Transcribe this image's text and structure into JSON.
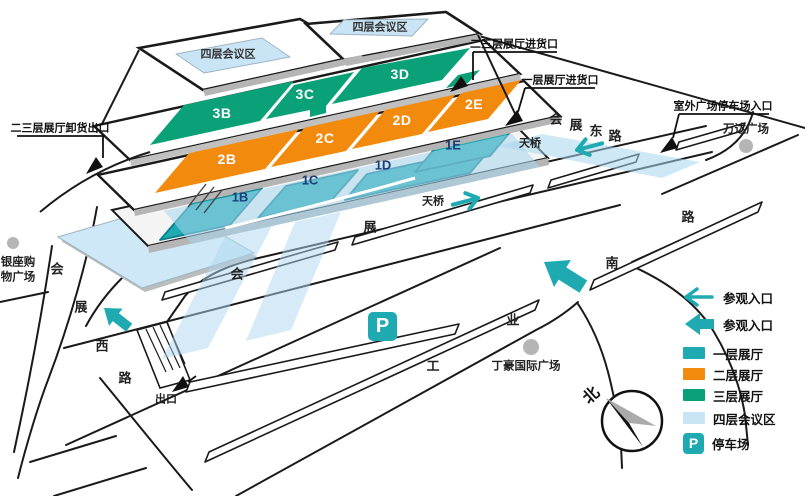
{
  "colors": {
    "teal": "#1FAAB2",
    "orange": "#F28B0D",
    "green": "#0AA178",
    "lightblue": "#C9E4F5",
    "navy": "#1A3E7C",
    "line": "#1a1a1a",
    "gray": "#B5B5B5"
  },
  "conference": {
    "left": "四层会议区",
    "right": "四层会议区"
  },
  "halls": {
    "f3": [
      "3B",
      "3C",
      "3D"
    ],
    "f2": [
      "2B",
      "2C",
      "2D",
      "2E"
    ],
    "f1": [
      "1B",
      "1C",
      "1D",
      "1E"
    ]
  },
  "callouts": {
    "load23": "二三层展厅进货口",
    "load1": "一层展厅进货口",
    "outdoor_parking": "室外广场停车场入口",
    "unload23": "二三层展厅卸货出口"
  },
  "places": {
    "wanda": "万达广场",
    "dinghao": "丁豪国际广场",
    "yinzuo_line1": "银座购",
    "yinzuo_line2": "物广场"
  },
  "roads": {
    "east": [
      "会",
      "展",
      "东",
      "路"
    ],
    "west": [
      "会",
      "展",
      "西",
      "路"
    ],
    "south": [
      "工",
      "业",
      "南",
      "路"
    ],
    "front": [
      "会",
      "展"
    ]
  },
  "bridges": {
    "b1": "天桥",
    "b2": "天桥"
  },
  "misc": {
    "exit": "出口",
    "parking_p": "P",
    "compass_north": "北"
  },
  "legend": {
    "items": [
      {
        "icon": "thin-arrow",
        "label": "参观入口"
      },
      {
        "icon": "thick-arrow",
        "label": "参观入口"
      },
      {
        "icon": "teal-swatch",
        "label": "一层展厅"
      },
      {
        "icon": "orange-swatch",
        "label": "二层展厅"
      },
      {
        "icon": "green-swatch",
        "label": "三层展厅"
      },
      {
        "icon": "lightblue-swatch",
        "label": "四层会议区"
      },
      {
        "icon": "parking",
        "label": "停车场"
      }
    ]
  }
}
